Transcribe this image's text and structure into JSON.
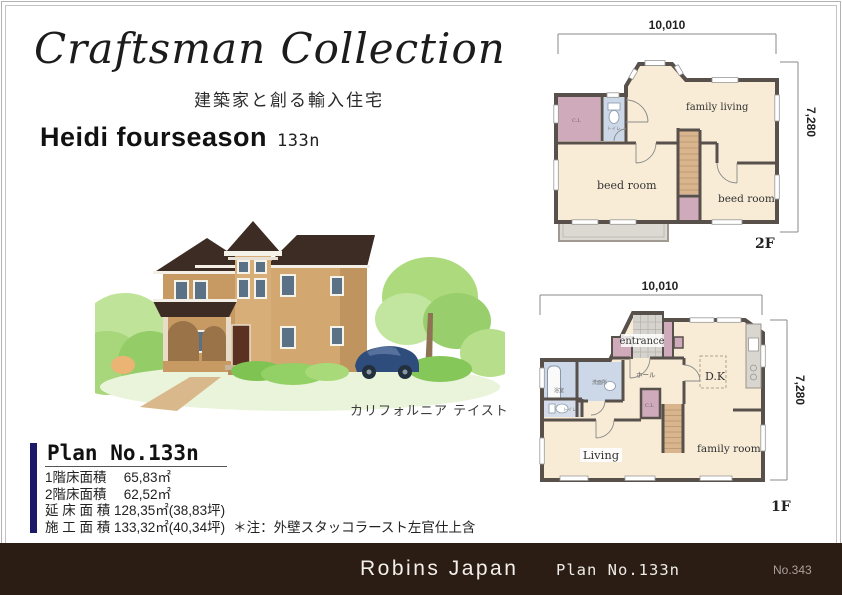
{
  "header": {
    "brand_script": "Craftsman Collection",
    "brand_subtitle": "建築家と創る輸入住宅",
    "model_name": "Heidi fourseason",
    "model_code": "133n"
  },
  "illustration": {
    "caption": "カリフォルニア テイスト",
    "colors": {
      "wall": "#d2a770",
      "wall_shade": "#c0945e",
      "roof": "#3c2c23",
      "foliage": "#a6d877",
      "car": "#2e4d7c",
      "path": "#d9b88c"
    }
  },
  "plan_summary": {
    "title": "Plan No.133n",
    "accent_bar_color": "#1c1a66",
    "rows": [
      "1階床面積　 65,83㎡",
      "2階床面積　 62,52㎡",
      "延 床 面 積 128,35㎡(38,83坪)",
      "施 工 面 積 133,32㎡(40,34坪)"
    ],
    "note": "＊注：外壁スタッコラースト左官仕上含"
  },
  "floor_plans": {
    "dim_width": "10,010",
    "dim_height": "7,280",
    "colors": {
      "wall": "#57504b",
      "room": "#f8ecd7",
      "closet_pink": "#cfaabb",
      "wet_blue": "#ccd7e8",
      "stairs": "#d9b48d",
      "tile": "#d6d3ce",
      "balcony": "#dcd9d3"
    },
    "second": {
      "floor_label": "2F",
      "room_family_living": "family living",
      "room_bedroom_left": "beed room",
      "room_bedroom_right": "beed room",
      "closet_label": "C.L",
      "toilet_label": "トイレ"
    },
    "first": {
      "floor_label": "1F",
      "room_entrance": "entrance",
      "room_hall": "ホール",
      "room_dk": "D.K",
      "room_living": "Living",
      "room_family": "family room",
      "room_bath": "浴室",
      "room_washroom": "洗面所",
      "room_toilet": "トイレ",
      "closet_label": "C.L"
    }
  },
  "footer": {
    "company": "Robins Japan",
    "plan_label": "Plan No.133n",
    "sheet_no": "No.343",
    "bar_color": "#2b1d14"
  }
}
